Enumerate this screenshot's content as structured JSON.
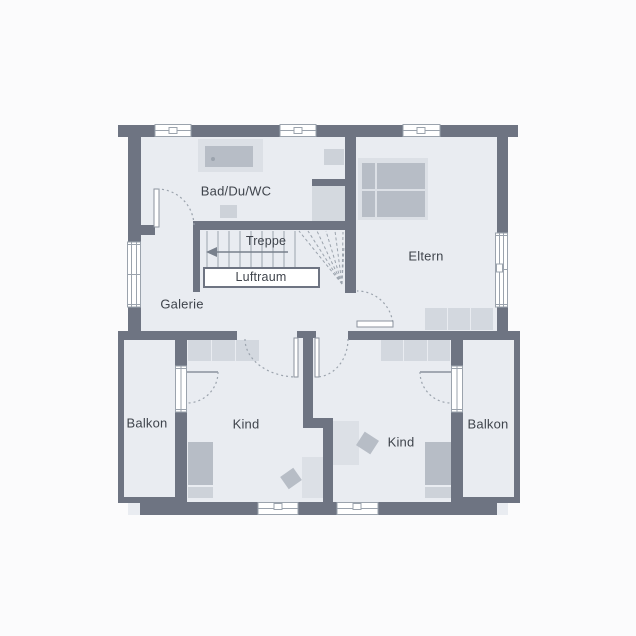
{
  "plan_title": "Obergeschoss Grundriss",
  "labels": {
    "bad": "Bad/Du/WC",
    "treppe": "Treppe",
    "luftraum": "Luftraum",
    "galerie": "Galerie",
    "eltern": "Eltern",
    "balkon_left": "Balkon",
    "kind_left": "Kind",
    "kind_right": "Kind",
    "balkon_right": "Balkon"
  },
  "colors": {
    "wall": "#6e7482",
    "floor": "#e9ecf1",
    "outside": "#fbfbfc",
    "furniture_light": "#d3d8df",
    "furniture_frame": "#dce0e6",
    "furniture_mid": "#b7bdc6",
    "fixture": "#cdd2d9",
    "shower": "#d4d9df",
    "line": "#9ba3ad",
    "leaf": "#8b929d",
    "arrow": "#78808c",
    "text": "#3f444c"
  }
}
